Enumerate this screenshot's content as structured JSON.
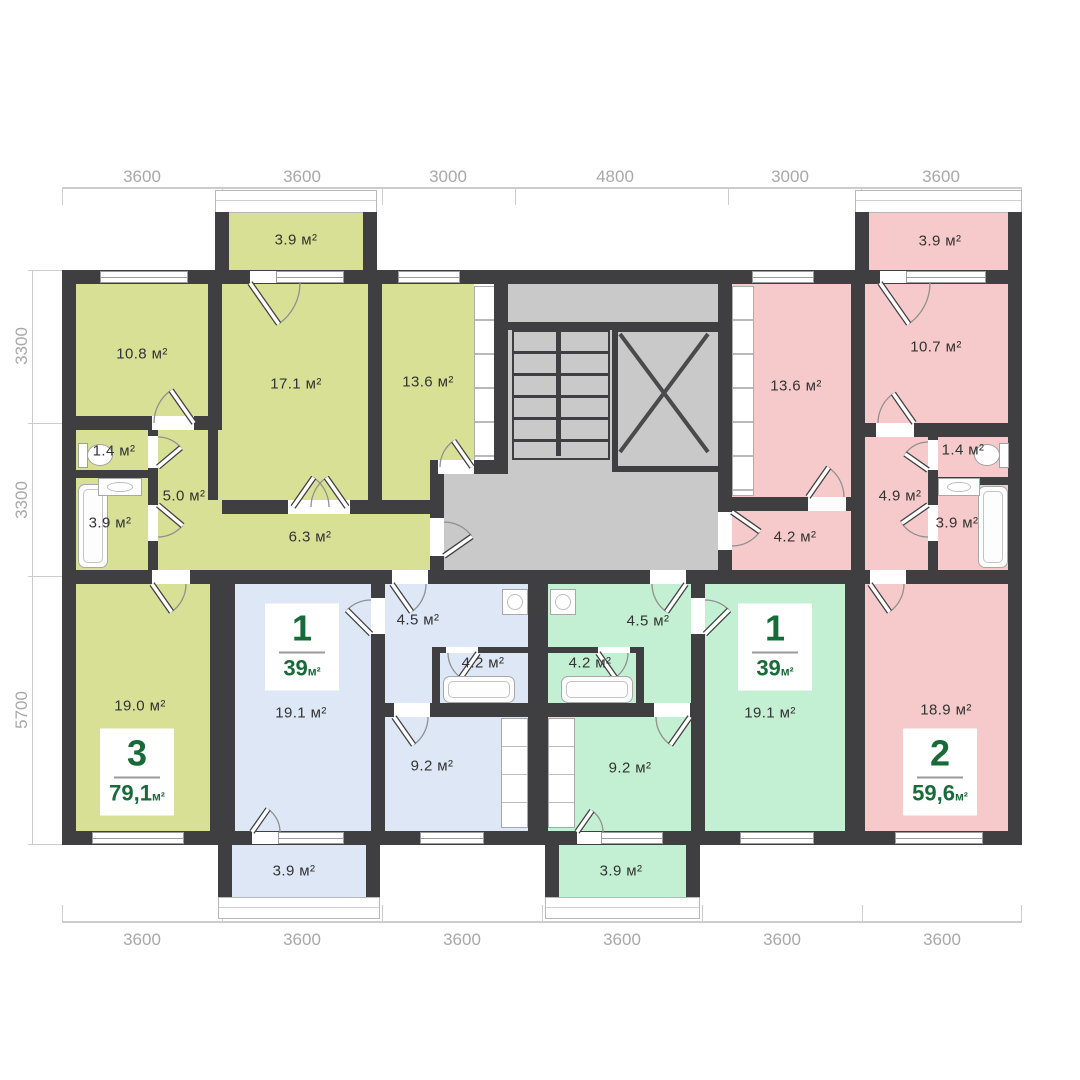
{
  "dimensions": {
    "top": [
      "3600",
      "3600",
      "3000",
      "4800",
      "3000",
      "3600"
    ],
    "left": [
      "3300",
      "3300",
      "5700"
    ],
    "bottom": [
      "3600",
      "3600",
      "3600",
      "3600",
      "3600",
      "3600"
    ]
  },
  "apartments": {
    "apt3": {
      "number": "3",
      "area": "79,1",
      "unit": "м²"
    },
    "apt1_blue": {
      "number": "1",
      "area": "39",
      "unit": "м²"
    },
    "apt1_mint": {
      "number": "1",
      "area": "39",
      "unit": "м²"
    },
    "apt2": {
      "number": "2",
      "area": "59,6",
      "unit": "м²"
    }
  },
  "rooms": {
    "olive": {
      "balcony": "3.9 м²",
      "bed1": "10.8 м²",
      "bed2": "17.1 м²",
      "bed3": "13.6 м²",
      "wc": "1.4 м²",
      "bath": "3.9 м²",
      "hall1": "5.0 м²",
      "hall2": "6.3 м²",
      "living": "19.0 м²"
    },
    "blue": {
      "hall": "4.5 м²",
      "bath": "4.2 м²",
      "kitchen": "9.2 м²",
      "living": "19.1 м²",
      "balcony": "3.9 м²"
    },
    "mint": {
      "hall": "4.5 м²",
      "bath": "4.2 м²",
      "kitchen": "9.2 м²",
      "living": "19.1 м²",
      "balcony": "3.9 м²"
    },
    "pink": {
      "balcony": "3.9 м²",
      "bed1": "13.6 м²",
      "bed2": "10.7 м²",
      "wc": "1.4 м²",
      "hall1": "4.9 м²",
      "bath": "3.9 м²",
      "hall2": "4.2 м²",
      "living": "18.9 м²"
    }
  },
  "colors": {
    "olive": "#d8e096",
    "blue": "#dde7f6",
    "mint": "#c3efd2",
    "pink": "#f6caca",
    "wall": "#3f3f41",
    "core_gray": "#c9c9c9",
    "accent_green": "#176b39",
    "dim_text": "#a8a8a8"
  }
}
